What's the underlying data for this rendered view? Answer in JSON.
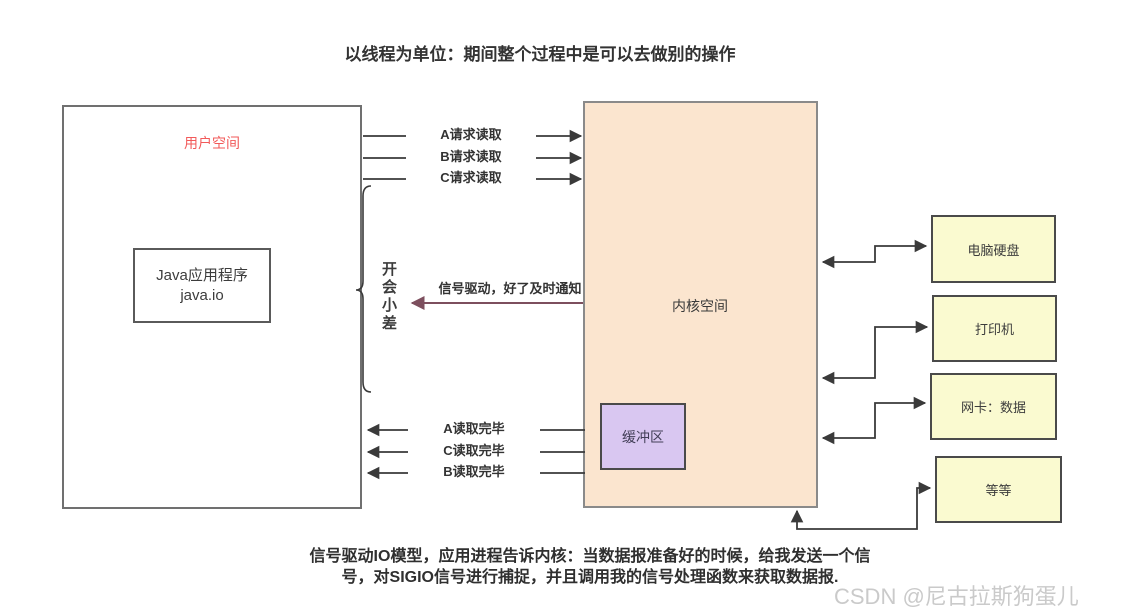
{
  "title": "以线程为单位：期间整个过程中是可以去做别的操作",
  "user_space": {
    "label": "用户空间",
    "label_color": "#f25a5a",
    "app_box": {
      "line1": "Java应用程序",
      "line2": "java.io"
    }
  },
  "kernel_space": {
    "label": "内核空间",
    "fill": "#fbe5cf"
  },
  "buffer": {
    "label": "缓冲区",
    "fill": "#d9c7f1"
  },
  "brace_note": {
    "text": "开会小差"
  },
  "request_arrows": [
    {
      "label": "A请求读取"
    },
    {
      "label": "B请求读取"
    },
    {
      "label": "C请求读取"
    }
  ],
  "signal_arrow": {
    "label": "信号驱动，好了及时通知",
    "color": "#7d4f5e"
  },
  "complete_arrows": [
    {
      "label": "A读取完毕"
    },
    {
      "label": "C读取完毕"
    },
    {
      "label": "B读取完毕"
    }
  ],
  "devices": [
    {
      "label": "电脑硬盘"
    },
    {
      "label": "打印机"
    },
    {
      "label": "网卡：数据"
    },
    {
      "label": "等等"
    }
  ],
  "caption": {
    "line1": "信号驱动IO模型，应用进程告诉内核：当数据报准备好的时候，给我发送一个信",
    "line2": "号，对SIGIO信号进行捕捉，并且调用我的信号处理函数来获取数据报."
  },
  "watermark": "CSDN @尼古拉斯狗蛋儿",
  "colors": {
    "device_fill": "#fafad0",
    "line": "#3a3a3a",
    "watermark": "#cacaca"
  }
}
